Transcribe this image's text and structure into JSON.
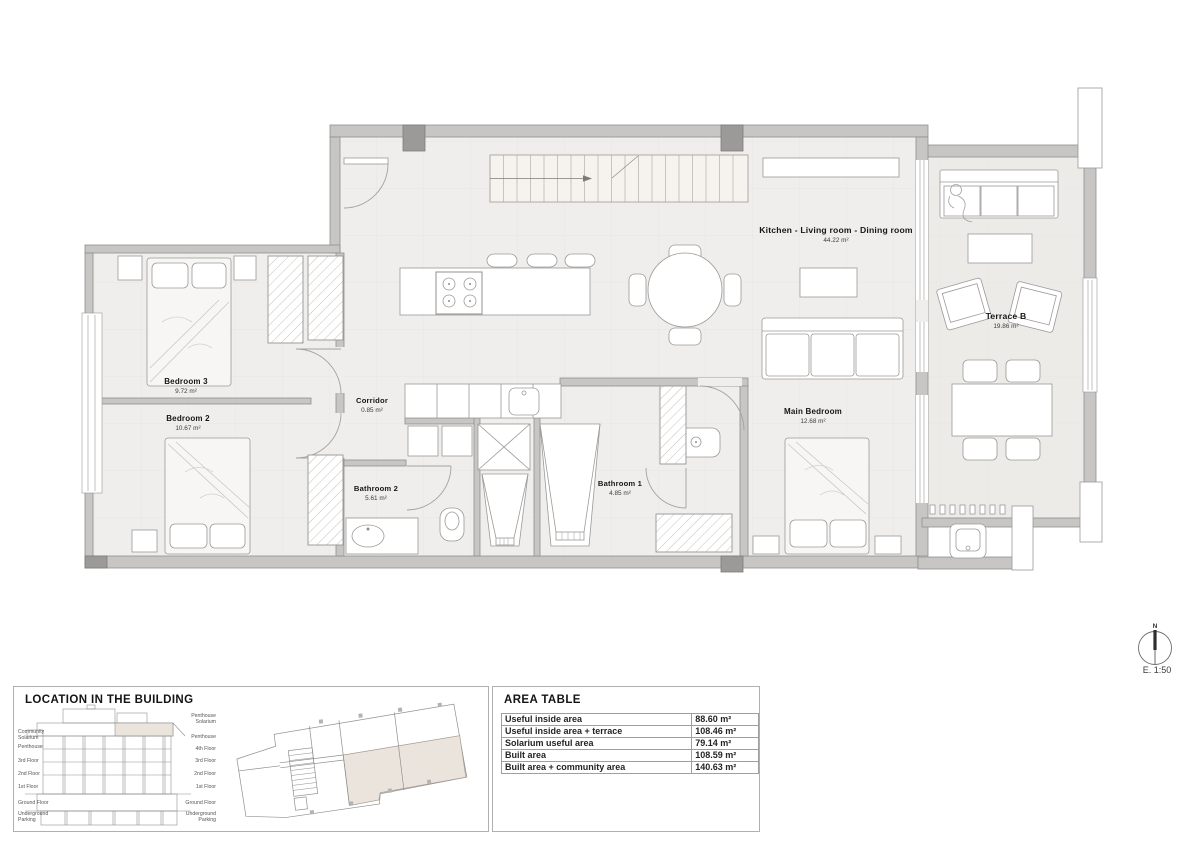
{
  "plan": {
    "rooms": [
      {
        "name": "Bedroom 3",
        "area": "9.72 m²"
      },
      {
        "name": "Bedroom 2",
        "area": "10.67 m²"
      },
      {
        "name": "Corridor",
        "area": "0.85 m²"
      },
      {
        "name": "Bathroom 2",
        "area": "5.61 m²"
      },
      {
        "name": "Bathroom 1",
        "area": "4.85 m²"
      },
      {
        "name": "Main Bedroom",
        "area": "12.68 m²"
      },
      {
        "name": "Kitchen - Living room - Dining room",
        "area": "44.22 m²"
      },
      {
        "name": "Terrace B",
        "area": "19.86 m²"
      }
    ],
    "north_label": "N",
    "scale_label": "E. 1:50"
  },
  "location_panel": {
    "title": "LOCATION IN THE BUILDING",
    "left_labels": [
      "Community Solarium",
      "Penthouse",
      "3rd Floor",
      "2nd Floor",
      "1st Floor",
      "Ground Floor",
      "Underground Parking"
    ],
    "right_labels": [
      "Penthouse Solarium",
      "Penthouse",
      "4th Floor",
      "3rd Floor",
      "2nd Floor",
      "1st Floor",
      "Ground Floor",
      "Underground Parking"
    ]
  },
  "area_table": {
    "title": "AREA TABLE",
    "rows": [
      {
        "label": "Useful inside area",
        "value": "88.60 m²"
      },
      {
        "label": "Useful inside area + terrace",
        "value": "108.46 m²"
      },
      {
        "label": "Solarium useful area",
        "value": "79.14 m²"
      },
      {
        "label": "Built area",
        "value": "108.59 m²"
      },
      {
        "label": "Built area + community area",
        "value": "140.63 m²"
      }
    ]
  },
  "colors": {
    "wall": "#c7c6c4",
    "floor": "#f0eeec",
    "terrace_floor": "#edebe7",
    "unit_highlight": "#ebe4dd"
  }
}
